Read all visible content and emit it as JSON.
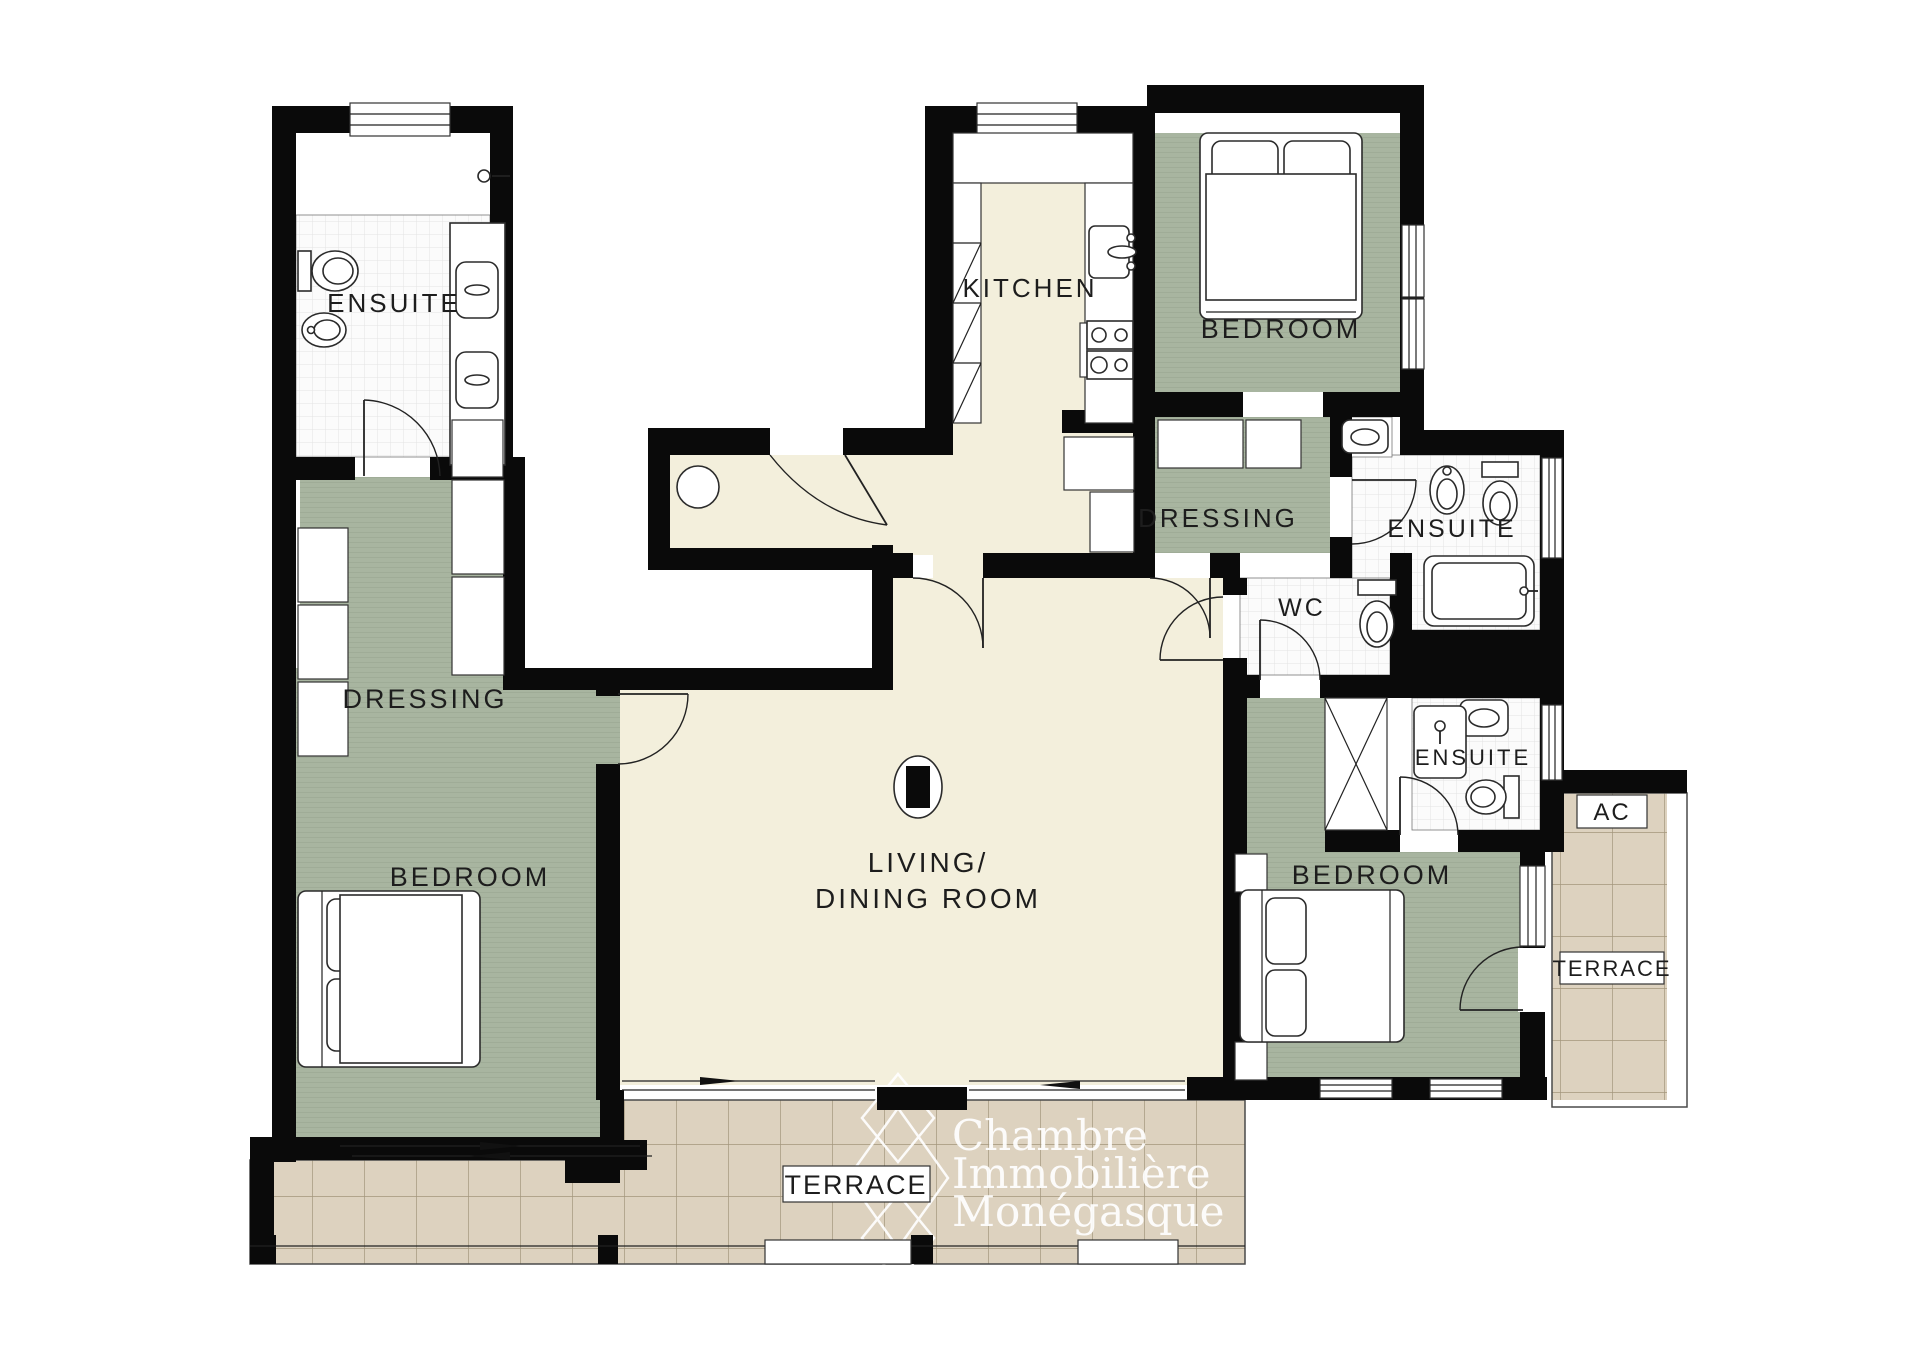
{
  "plan": {
    "title": "Apartment floor plan",
    "colors": {
      "wall": "#0a0a0a",
      "room_green": "#a8b5a0",
      "room_cream": "#f3efdc",
      "terrace_tan": "#ddd2bf",
      "tile_line": "#e3e3e3",
      "terrace_line": "#a3967c",
      "watermark": "#ffffff"
    },
    "rooms": {
      "ensuite_tl": "ENSUITE",
      "kitchen": "KITCHEN",
      "bedroom_tr": "BEDROOM",
      "dressing_r": "DRESSING",
      "ensuite_r": "ENSUITE",
      "wc": "WC",
      "ensuite_br": "ENSUITE",
      "dressing_l": "DRESSING",
      "bedroom_l": "BEDROOM",
      "living_line1": "LIVING/",
      "living_line2": "DINING ROOM",
      "bedroom_br": "BEDROOM",
      "ac": "AC",
      "terrace_right": "TERRACE",
      "terrace_bottom": "TERRACE"
    },
    "watermark": {
      "line1": "Chambre",
      "line2": "Immobilière",
      "line3": "Monégasque"
    }
  }
}
